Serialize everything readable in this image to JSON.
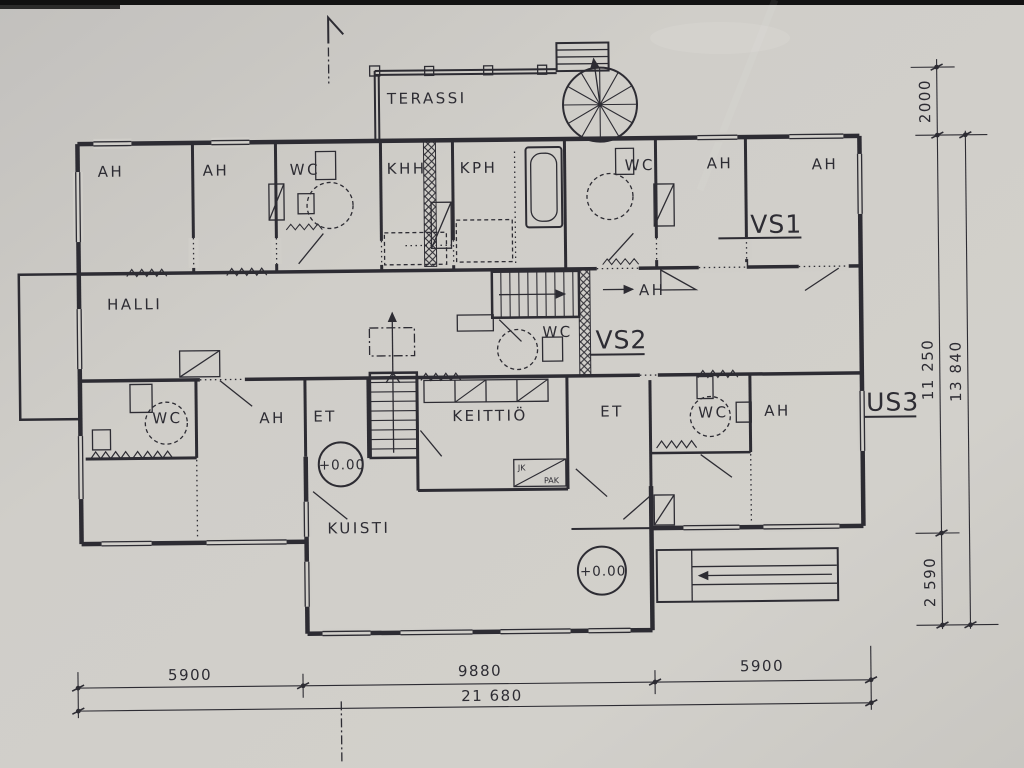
{
  "plan": {
    "room_labels": {
      "terassi": "TERASSI",
      "halli": "HALLI",
      "kuisti": "KUISTI",
      "keittio": "KEITTIÖ",
      "ah": "AH",
      "wc": "WC",
      "khh": "KHH",
      "kph": "KPH",
      "et": "ET",
      "jk": "JK",
      "pak": "PAK"
    },
    "wall_type_markers": {
      "vs1": "VS1",
      "vs2": "VS2",
      "us3": "US3"
    },
    "elevation_marker": "+0.00",
    "dimensions": {
      "right_side": {
        "terassi_depth": "2000",
        "main_body_height": "11 250",
        "total_height": "13 840",
        "kuisti_depth": "2 590"
      },
      "bottom": {
        "left_segment": "5900",
        "middle_segment": "9880",
        "right_segment": "5900",
        "total_width": "21 680"
      }
    }
  }
}
